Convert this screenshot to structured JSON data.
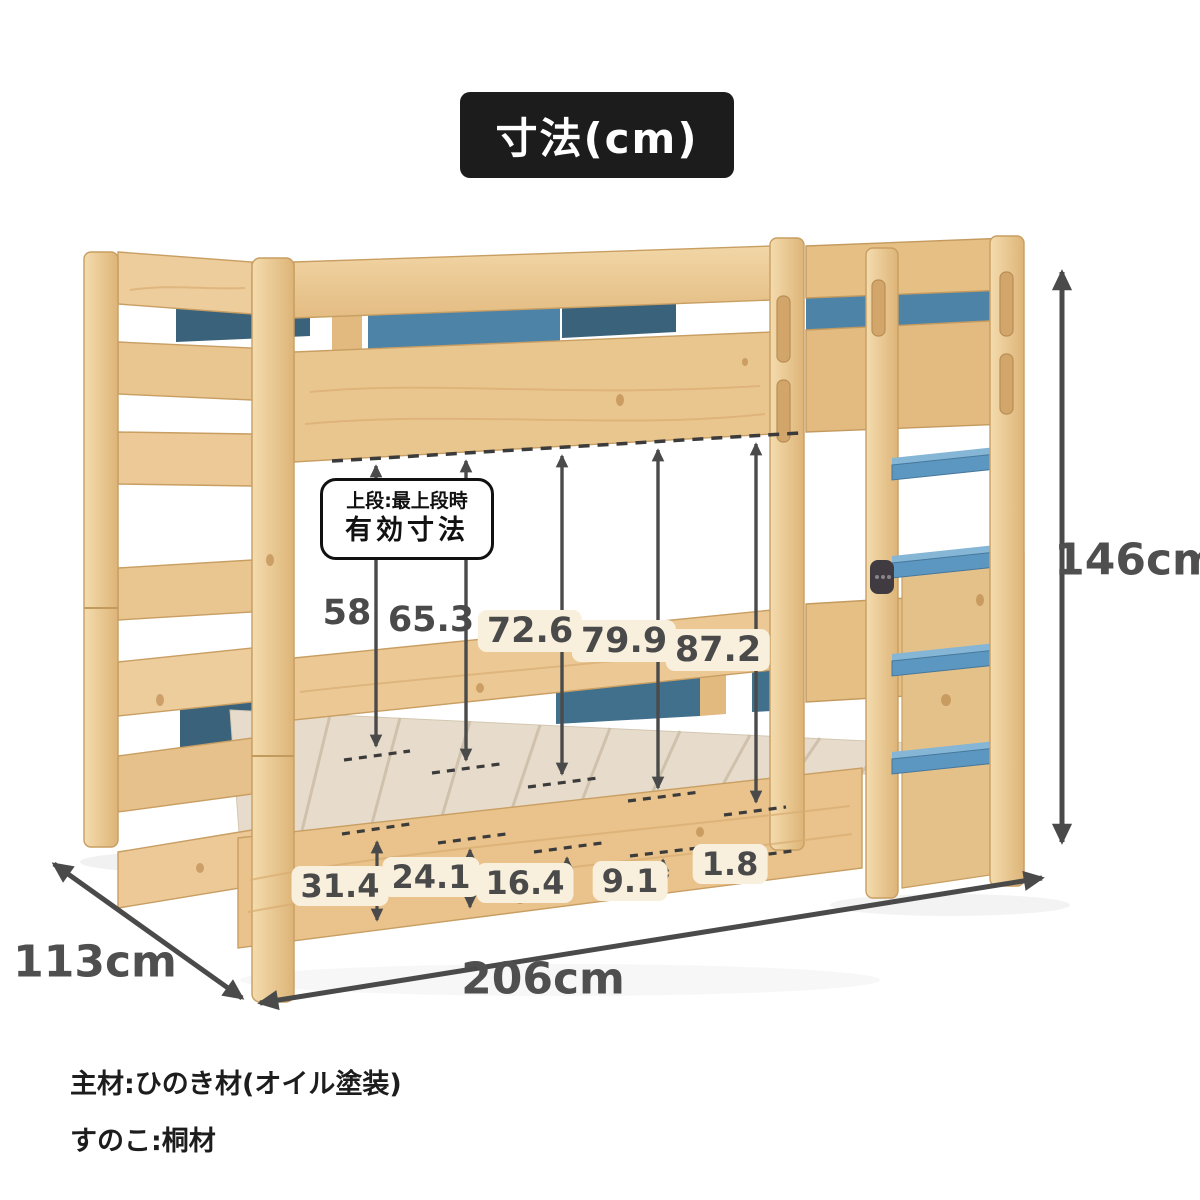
{
  "badge": {
    "label": "寸法(cm)"
  },
  "callout": {
    "line1": "上段:最上段時",
    "line2": "有効寸法"
  },
  "dimensions": {
    "height": "146cm",
    "depth": "113cm",
    "length": "206cm"
  },
  "clearance_heights": [
    "58",
    "65.3",
    "72.6",
    "79.9",
    "87.2"
  ],
  "platform_heights": [
    "31.4",
    "24.1",
    "16.4",
    "9.1",
    "1.8"
  ],
  "notes": [
    "主材:ひのき材(オイル塗装)",
    "すのこ:桐材"
  ],
  "colors": {
    "wood": "#eac68f",
    "wood_light": "#f0d2a2",
    "wood_shadow": "#c89e62",
    "slats": "#e7dccb",
    "panel_blue": "#4e83a8",
    "panel_blue_dark": "#3a627b",
    "step_blue": "#5b97c0",
    "annotation_gray": "#4a4a4a",
    "badge_bg": "#1c1c1c",
    "chip_bg": "#f8f0dd"
  }
}
